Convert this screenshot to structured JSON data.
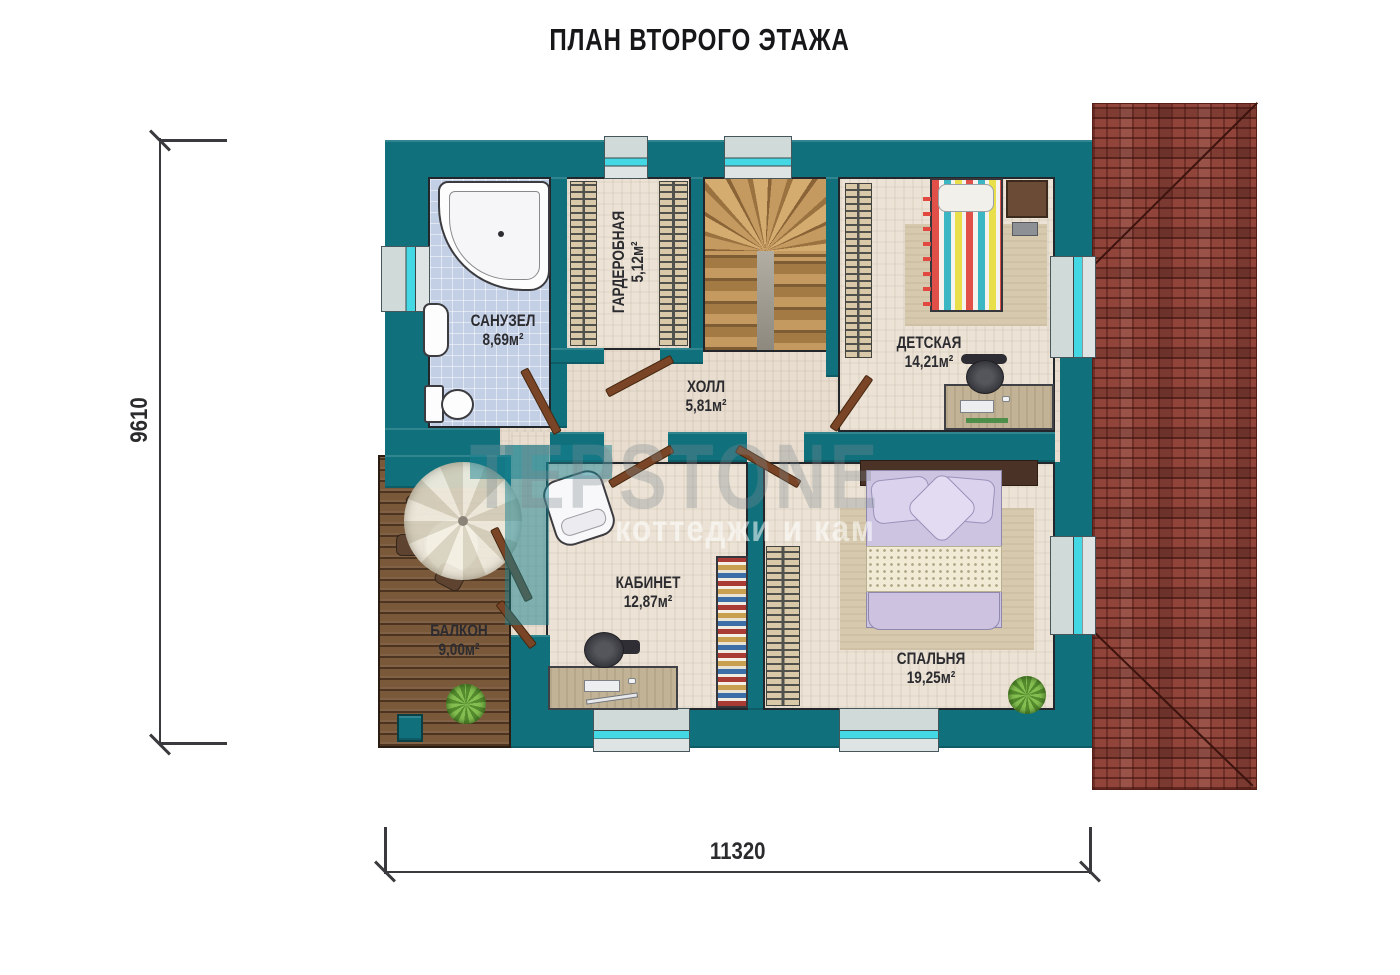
{
  "title": "ПЛАН ВТОРОГО ЭТАЖА",
  "dimensions": {
    "height_label": "9610",
    "width_label": "11320"
  },
  "rooms": [
    {
      "id": "bathroom",
      "name": "САНУЗЕЛ",
      "area": "8,69м²"
    },
    {
      "id": "wardrobe",
      "name": "ГАРДЕРОБНАЯ",
      "area": "5,12м²"
    },
    {
      "id": "hall",
      "name": "ХОЛЛ",
      "area": "5,81м²"
    },
    {
      "id": "children",
      "name": "ДЕТСКАЯ",
      "area": "14,21м²"
    },
    {
      "id": "office",
      "name": "КАБИНЕТ",
      "area": "12,87м²"
    },
    {
      "id": "balcony",
      "name": "БАЛКОН",
      "area": "9,00м²"
    },
    {
      "id": "bedroom",
      "name": "СПАЛЬНЯ",
      "area": "19,25м²"
    }
  ],
  "watermark": {
    "logo": "TEPSTONE",
    "subtext": "коттеджи и кам"
  },
  "colors": {
    "wall_teal": "#10717d",
    "roof_brick": "#91443a",
    "window_cyan": "#44d8e4",
    "deck_wood": "#7a583a",
    "floor_beige": "#e8ddcf",
    "bath_tile": "#c3cfe4",
    "label_dark": "#2c2c30"
  }
}
